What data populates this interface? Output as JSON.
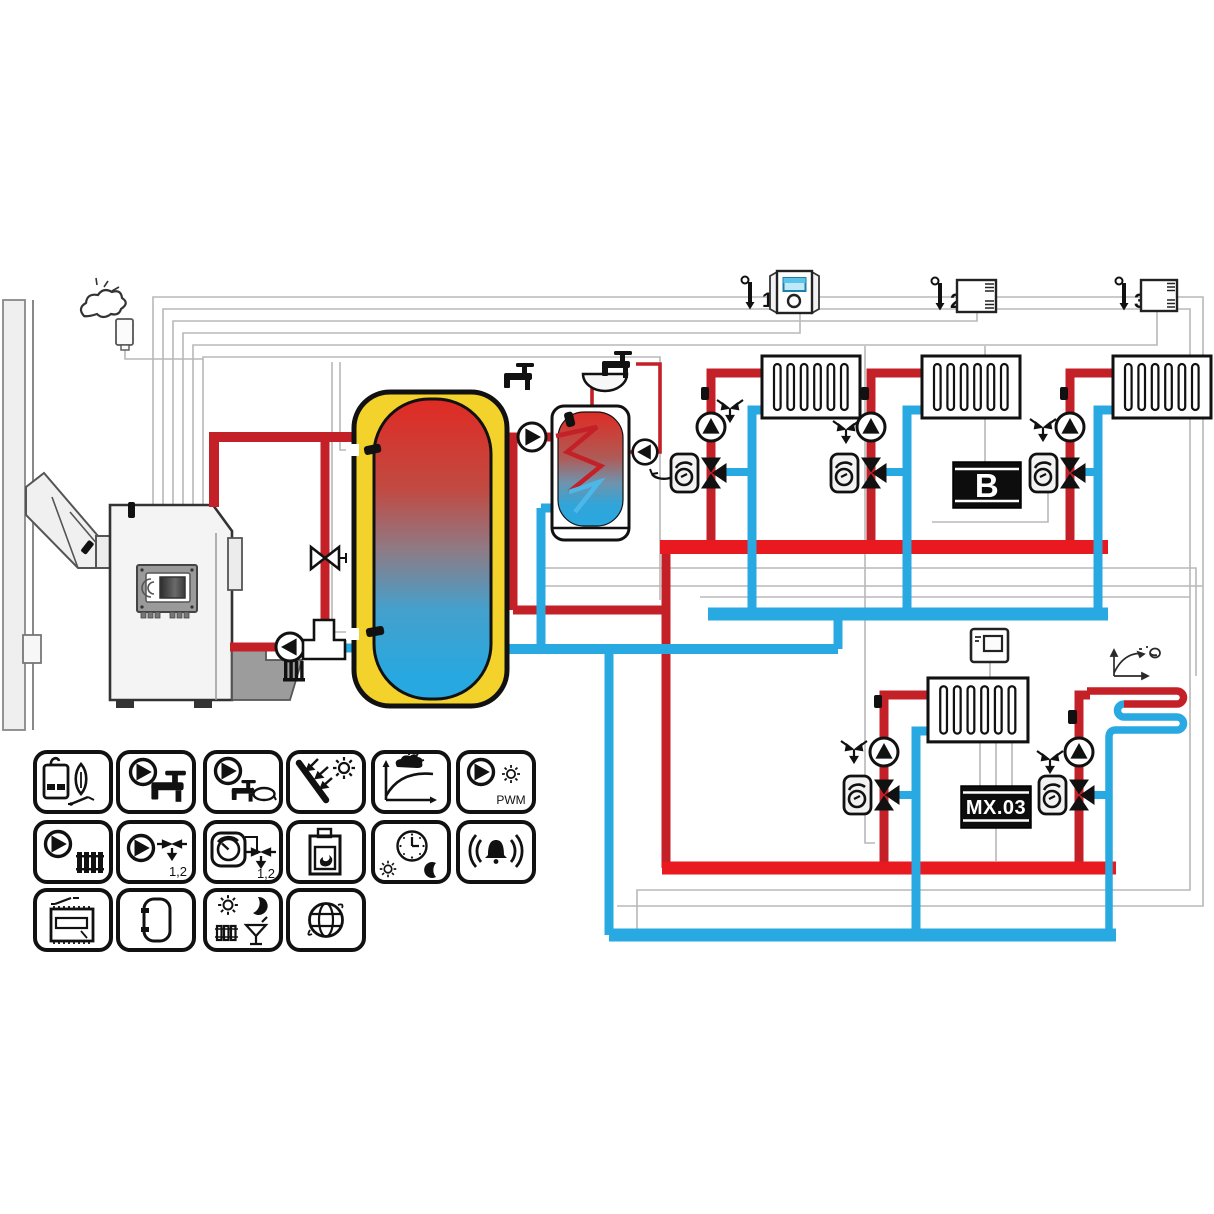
{
  "app": {
    "type": "heating-system-hydraulic-schematic"
  },
  "colors": {
    "hot_pipe": "#c32127",
    "hot_bus": "#e8191f",
    "cold_pipe": "#29a9e1",
    "buffer_jacket": "#f2d22b",
    "control_wire": "#b8b8b8",
    "module_box": "#0d0d0d",
    "room_display": "#bfe8f8"
  },
  "labels": {
    "room_sensor_1": "1",
    "room_sensor_2": "2",
    "room_sensor_3": "3",
    "module_b": "B",
    "module_mx03": "MX.03",
    "legend_pwm": "PWM",
    "legend_mix_pump": "1,2",
    "legend_mix_dial": "1,2"
  },
  "components": [
    "chimney",
    "outdoor-sensor",
    "pellet-boiler",
    "boiler-controller",
    "return-pump",
    "thermic-bypass-valve",
    "buffer-tank",
    "dhw-charge-pump",
    "dhw-tank",
    "sink-faucet",
    "dhw-circulation-pump",
    "heating-circuit-1",
    "heating-circuit-2",
    "heating-circuit-3",
    "expansion-module-B",
    "room-unit-1",
    "room-unit-2",
    "room-unit-3",
    "lower-zone-thermostat",
    "heating-circuit-4",
    "mixer-module-MX03",
    "floor-heating-circuit",
    "heating-curve-sketch"
  ],
  "legend": {
    "items": [
      {
        "name": "boiler-burner-contact"
      },
      {
        "name": "dhw-pump"
      },
      {
        "name": "dhw-circulation-pump"
      },
      {
        "name": "solar-collector"
      },
      {
        "name": "weather-compensation-curve"
      },
      {
        "name": "pwm-pump"
      },
      {
        "name": "heating-circuit-pump"
      },
      {
        "name": "mixing-valve-pump-1-2"
      },
      {
        "name": "mixing-valve-dial-1-2"
      },
      {
        "name": "solid-fuel-stove"
      },
      {
        "name": "time-program-day-night"
      },
      {
        "name": "alarm"
      },
      {
        "name": "relay-module"
      },
      {
        "name": "buffer-tank"
      },
      {
        "name": "comfort-party-mode"
      },
      {
        "name": "internet-connection"
      }
    ]
  }
}
